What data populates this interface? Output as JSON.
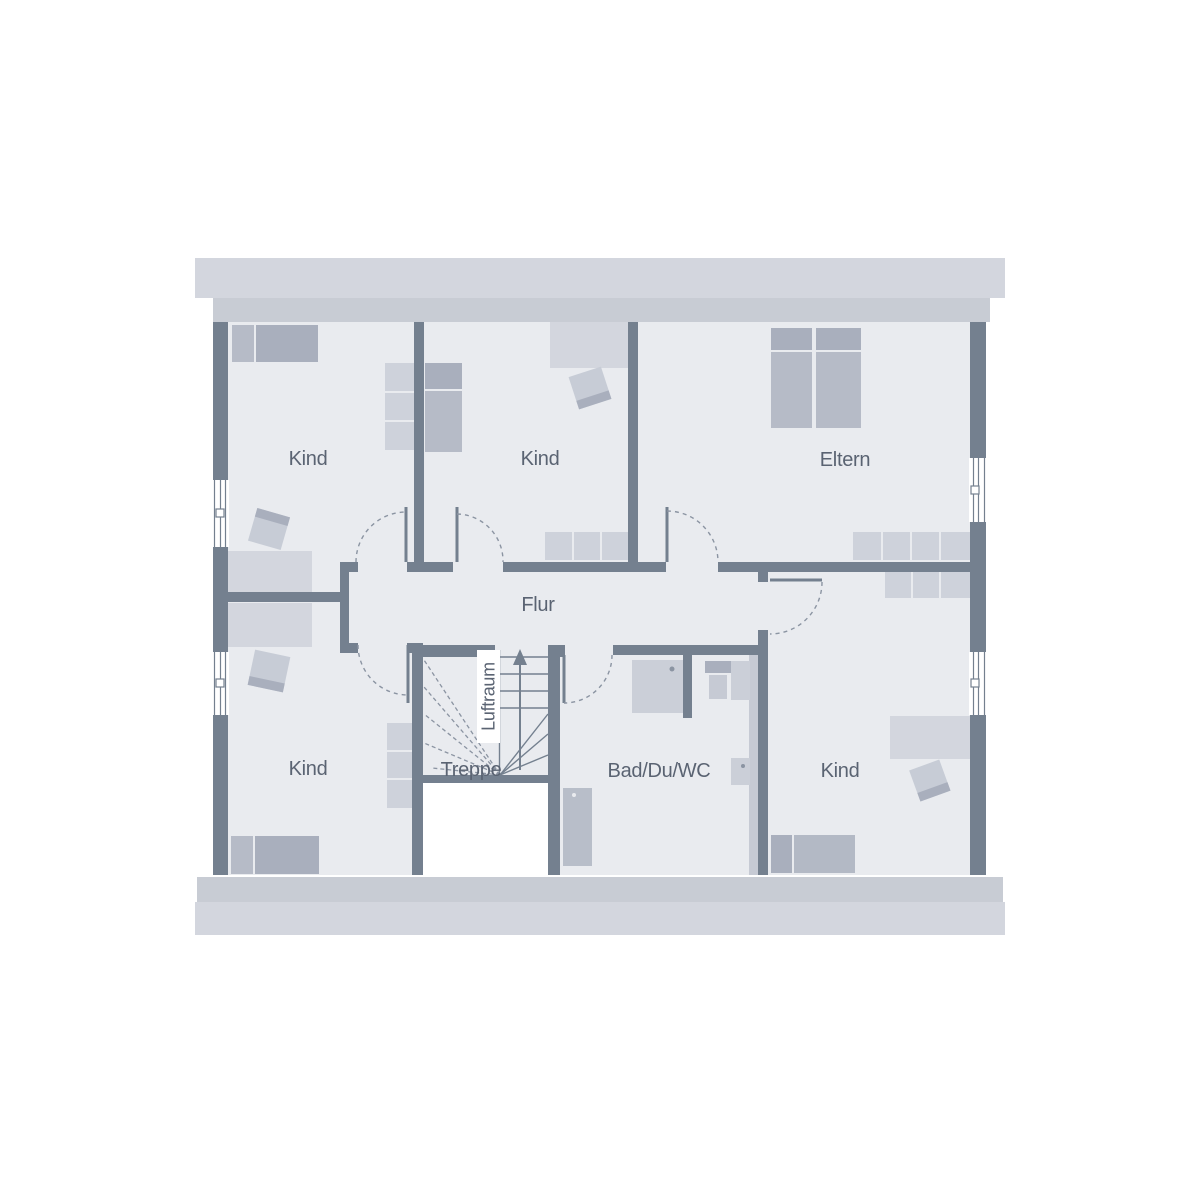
{
  "labels": {
    "kind_top_left": "Kind",
    "kind_top_middle": "Kind",
    "eltern": "Eltern",
    "kind_bottom_left": "Kind",
    "kind_bottom_right": "Kind",
    "flur": "Flur",
    "treppe": "Treppe",
    "bad": "Bad/Du/WC",
    "luftraum": "Luftraum"
  },
  "colors": {
    "wall": "#74808f",
    "floor": "#e9ebef",
    "roof_band": "#d3d6de",
    "wall_plate_band": "#c8ccd4",
    "furniture_light": "#d2d5dd",
    "furniture_medium": "#b6bbc7",
    "furniture_dark": "#a9afbd",
    "fixture": "#cbcfd8",
    "label_text": "#5a6372",
    "door_swing": "#8b94a2"
  }
}
